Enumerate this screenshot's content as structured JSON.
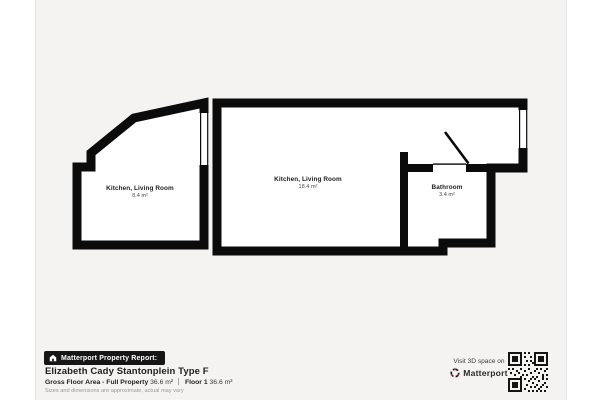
{
  "canvas": {
    "background": "#f4f3f1",
    "wall_color": "#0b0b0b"
  },
  "floorplan": {
    "rooms": [
      {
        "name": "Kitchen, Living Room",
        "area": "8.4 m²"
      },
      {
        "name": "Kitchen, Living Room",
        "area": "18.4 m²"
      },
      {
        "name": "Bathroom",
        "area": "3.4 m²"
      }
    ]
  },
  "report": {
    "badge_label": "Matterport Property Report:",
    "title": "Elizabeth Cady Stantonplein Type F",
    "area_label": "Gross Floor Area - Full Property",
    "area_value": "36.6 m²",
    "floor_label": "Floor 1",
    "floor_value": "36.6 m²",
    "disclaimer": "Sizes and dimensions are approximate, actual may vary"
  },
  "footer": {
    "visit_label": "Visit 3D space on",
    "brand_name": "Matterport",
    "brand_red": "#ff3158"
  }
}
